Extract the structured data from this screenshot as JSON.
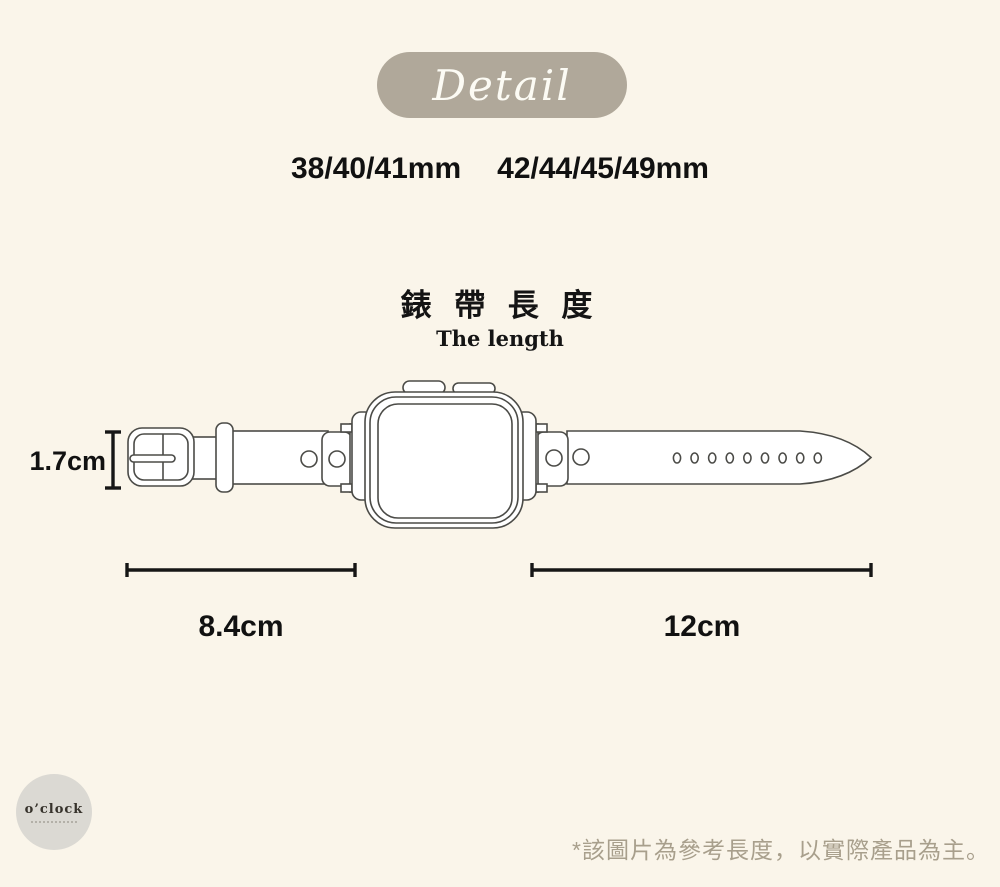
{
  "page": {
    "background": "#FAF5EA"
  },
  "badge": {
    "label": "Detail",
    "bg": "#B0A89A",
    "text_color": "#FCFBF4"
  },
  "sizes": {
    "small": "38/40/41mm",
    "large": "42/44/45/49mm"
  },
  "section": {
    "title": "錶 帶 長 度",
    "subtitle": "The length"
  },
  "measurements": {
    "strap_width": "1.7cm",
    "buckle_side_length": "8.4cm",
    "hole_side_length": "12cm"
  },
  "logo": {
    "name": "o’clock"
  },
  "footnote": {
    "text": "*該圖片為參考長度，以實際產品為主。"
  }
}
